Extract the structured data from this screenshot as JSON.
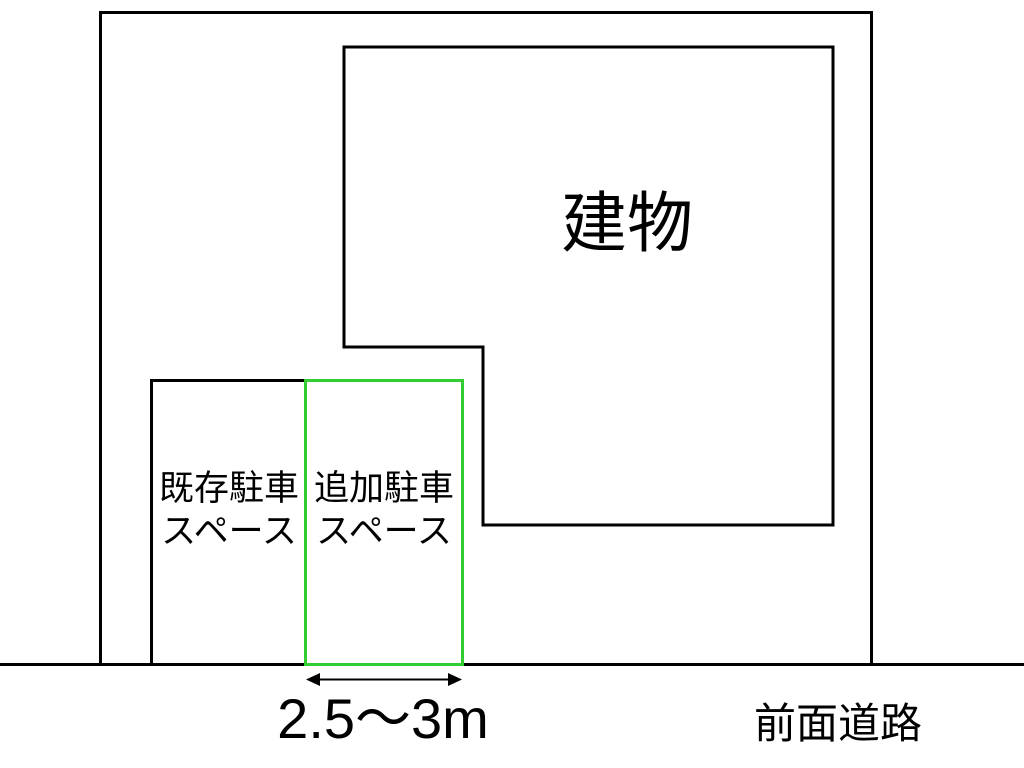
{
  "diagram": {
    "building": {
      "label": "建物"
    },
    "existing_parking": {
      "label_line1": "既存駐車",
      "label_line2": "スペース"
    },
    "additional_parking": {
      "label_line1": "追加駐車",
      "label_line2": "スペース"
    },
    "dimension": {
      "label": "2.5〜3m"
    },
    "road": {
      "label": "前面道路"
    },
    "colors": {
      "outline": "#000000",
      "parking_highlight": "#32CD32",
      "background": "#ffffff"
    }
  }
}
